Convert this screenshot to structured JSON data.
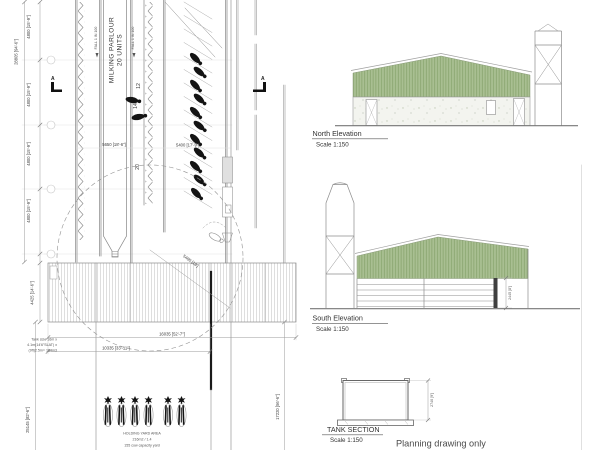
{
  "document": {
    "type_note": "Planning drawing only"
  },
  "plan": {
    "parlour": {
      "line1": "MILKING PARLOUR",
      "line2": "20 UNITS"
    },
    "fall_note": "FALL 1 IN 100",
    "section_marker": "A",
    "stall_numbers": [
      "12",
      "14",
      "20"
    ],
    "dims": {
      "bay": "4800 [15'-9\"]",
      "overall": "28805 [94'-6\"]",
      "parlour_width": "5650 [18'-6\"]",
      "pit_width": "5400 [17'-9\"]",
      "diag": "5480 [18']",
      "yard_depth": "4425 [14'-6\"]",
      "yard_width": "16035 [52'-7\"]",
      "yard_inner": "10335 [33'-11\"]",
      "site_left": "25145 [82'-6\"]",
      "site_right": "17220 [56'-6\"]"
    },
    "tank_note": {
      "line1": "Tank size 16m x",
      "line2": "4.1m(14'6\"SLAT) x",
      "line3": "(9ft)2.5m= 164m3"
    },
    "holding_yard": {
      "line1": "HOLDING YARD AREA",
      "line2": "216m2 / 1.4",
      "line3": "155 cow capacity yard"
    }
  },
  "north_elevation": {
    "label": "North Elevation",
    "scale": "Scale 1:150"
  },
  "south_elevation": {
    "label": "South Elevation",
    "scale": "Scale 1:150",
    "height_dim": "2445 [8']"
  },
  "tank_section": {
    "label": "TANK SECTION",
    "scale": "Scale 1:150",
    "height_dim": "2740 [9']"
  },
  "colors": {
    "roof_green": "#a9bf92",
    "roof_stripe": "#83a168",
    "wall_fill": "#f3f4ef",
    "line": "#8c8c8c",
    "text": "#3d3d3d"
  }
}
